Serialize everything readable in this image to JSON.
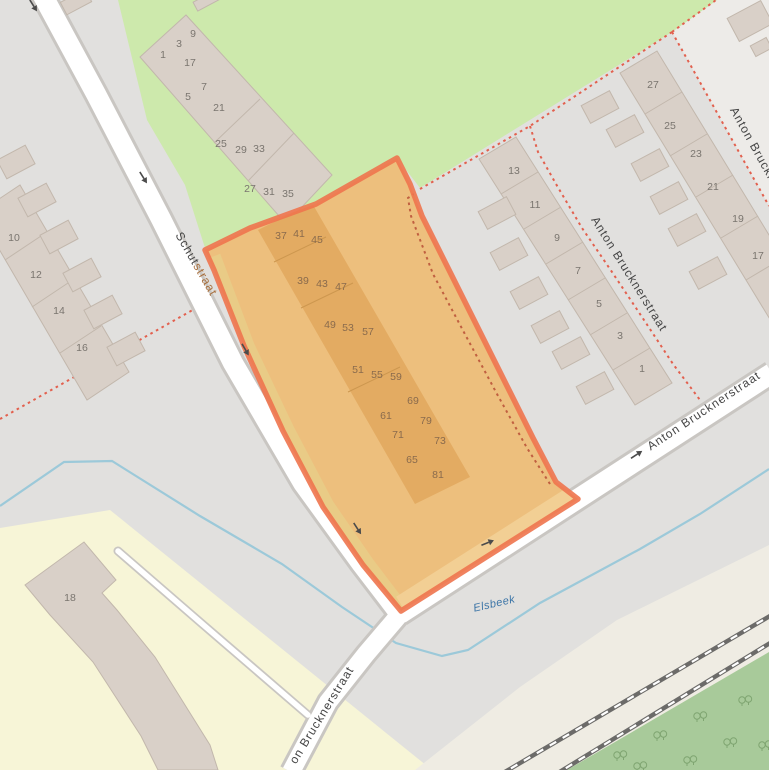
{
  "map": {
    "style": "openstreetmap",
    "labels": {
      "streets": [
        {
          "id": "schutstraat",
          "text": "Schutstraat",
          "part_plain": "Schut",
          "part_tinted": "straat",
          "x": 193,
          "y": 266,
          "rot": 60
        },
        {
          "id": "anton-bruckner-footpath",
          "text": "Anton Brucknerstraat",
          "x": 626,
          "y": 276,
          "rot": 58
        },
        {
          "id": "anton-bruckner-right-edge",
          "text": "Anton Bruckne",
          "x": 752,
          "y": 150,
          "rot": 61
        },
        {
          "id": "anton-bruckner-main-road",
          "text": "Anton Brucknerstraat",
          "x": 706,
          "y": 414,
          "rot": -33.5
        },
        {
          "id": "anton-bruckner-south-cut",
          "text": "on Brucknerstraat",
          "x": 325,
          "y": 717,
          "rot": -58.5
        }
      ],
      "water": {
        "text": "Elsbeek",
        "x": 495,
        "y": 607,
        "rot": -13
      }
    },
    "house_numbers": {
      "west_terrace": [
        {
          "n": "10",
          "x": 14,
          "y": 241
        },
        {
          "n": "12",
          "x": 36,
          "y": 278
        },
        {
          "n": "14",
          "x": 59,
          "y": 314
        },
        {
          "n": "16",
          "x": 82,
          "y": 351
        }
      ],
      "northwest_terrace": [
        {
          "n": "1",
          "x": 163,
          "y": 58
        },
        {
          "n": "3",
          "x": 179,
          "y": 47
        },
        {
          "n": "9",
          "x": 193,
          "y": 37
        },
        {
          "n": "17",
          "x": 190,
          "y": 66
        },
        {
          "n": "5",
          "x": 188,
          "y": 100
        },
        {
          "n": "7",
          "x": 204,
          "y": 90
        },
        {
          "n": "21",
          "x": 219,
          "y": 111
        },
        {
          "n": "25",
          "x": 221,
          "y": 147
        },
        {
          "n": "29",
          "x": 241,
          "y": 153
        },
        {
          "n": "33",
          "x": 259,
          "y": 152
        },
        {
          "n": "27",
          "x": 250,
          "y": 192
        },
        {
          "n": "31",
          "x": 269,
          "y": 195
        },
        {
          "n": "35",
          "x": 288,
          "y": 197
        }
      ],
      "east_row_inner": [
        {
          "n": "13",
          "x": 514,
          "y": 174
        },
        {
          "n": "11",
          "x": 535,
          "y": 208
        },
        {
          "n": "9",
          "x": 557,
          "y": 241
        },
        {
          "n": "7",
          "x": 578,
          "y": 274
        },
        {
          "n": "5",
          "x": 599,
          "y": 307
        },
        {
          "n": "3",
          "x": 620,
          "y": 339
        },
        {
          "n": "1",
          "x": 642,
          "y": 372
        }
      ],
      "east_row_outer": [
        {
          "n": "27",
          "x": 653,
          "y": 88
        },
        {
          "n": "25",
          "x": 670,
          "y": 129
        },
        {
          "n": "23",
          "x": 696,
          "y": 157
        },
        {
          "n": "21",
          "x": 713,
          "y": 190
        },
        {
          "n": "19",
          "x": 738,
          "y": 222
        },
        {
          "n": "17",
          "x": 758,
          "y": 259
        }
      ],
      "school": [
        {
          "n": "18",
          "x": 70,
          "y": 601
        }
      ],
      "selection_buildings": [
        {
          "n": "37",
          "x": 281,
          "y": 239
        },
        {
          "n": "41",
          "x": 299,
          "y": 237
        },
        {
          "n": "45",
          "x": 317,
          "y": 243
        },
        {
          "n": "39",
          "x": 303,
          "y": 284
        },
        {
          "n": "43",
          "x": 322,
          "y": 287
        },
        {
          "n": "47",
          "x": 341,
          "y": 290
        },
        {
          "n": "49",
          "x": 330,
          "y": 328
        },
        {
          "n": "53",
          "x": 348,
          "y": 331
        },
        {
          "n": "57",
          "x": 368,
          "y": 335
        },
        {
          "n": "51",
          "x": 358,
          "y": 373
        },
        {
          "n": "55",
          "x": 377,
          "y": 378
        },
        {
          "n": "59",
          "x": 396,
          "y": 380
        },
        {
          "n": "61",
          "x": 386,
          "y": 419
        },
        {
          "n": "69",
          "x": 413,
          "y": 404
        },
        {
          "n": "79",
          "x": 426,
          "y": 424
        },
        {
          "n": "71",
          "x": 398,
          "y": 438
        },
        {
          "n": "73",
          "x": 440,
          "y": 444
        },
        {
          "n": "65",
          "x": 412,
          "y": 463
        },
        {
          "n": "81",
          "x": 438,
          "y": 478
        }
      ]
    },
    "oneway_arrows": [
      {
        "x": 33,
        "y": 5,
        "rot": 58
      },
      {
        "x": 143,
        "y": 177,
        "rot": 58
      },
      {
        "x": 245,
        "y": 349,
        "rot": 60
      },
      {
        "x": 357,
        "y": 528,
        "rot": 57
      },
      {
        "x": 487,
        "y": 543,
        "rot": -22
      },
      {
        "x": 636,
        "y": 455,
        "rot": -33
      }
    ],
    "forest_trees": [
      {
        "x": 620,
        "y": 755
      },
      {
        "x": 660,
        "y": 735
      },
      {
        "x": 700,
        "y": 716
      },
      {
        "x": 745,
        "y": 700
      },
      {
        "x": 765,
        "y": 745
      },
      {
        "x": 690,
        "y": 760
      },
      {
        "x": 730,
        "y": 742
      },
      {
        "x": 640,
        "y": 766
      }
    ],
    "colors": {
      "base": "#e1e0de",
      "residential_light": "#edebe8",
      "grass": "#cde9ac",
      "forest": "#a8ca9a",
      "tree_icon": "#7fa571",
      "school_yellow": "#f7f5d7",
      "railway_corridor": "#efece3",
      "building": "#d9d0c8",
      "building_outline": "#c2b7ac",
      "road_fill": "#ffffff",
      "road_casing": "#c9c6c2",
      "water": "#9cc9d9",
      "footpath_dashed": "#e2604e",
      "footpath_dashed_in_selection": "#c05f40",
      "railway": "#6c6b69",
      "selection_fill": "#edbf7d",
      "selection_border": "#ee744e",
      "selection_building": "#e3ab62",
      "selection_building_outline": "#cd974f",
      "selection_road_strip_west": "#e9cb86",
      "selection_road_strip_southeast": "#f2cf94",
      "label_street": "#454545",
      "label_street_tinted": "#a8703f",
      "label_water": "#3c75a7",
      "number": "#7a756f",
      "number_selection": "#8a6b4d",
      "arrow": "#4b4b4b"
    }
  }
}
